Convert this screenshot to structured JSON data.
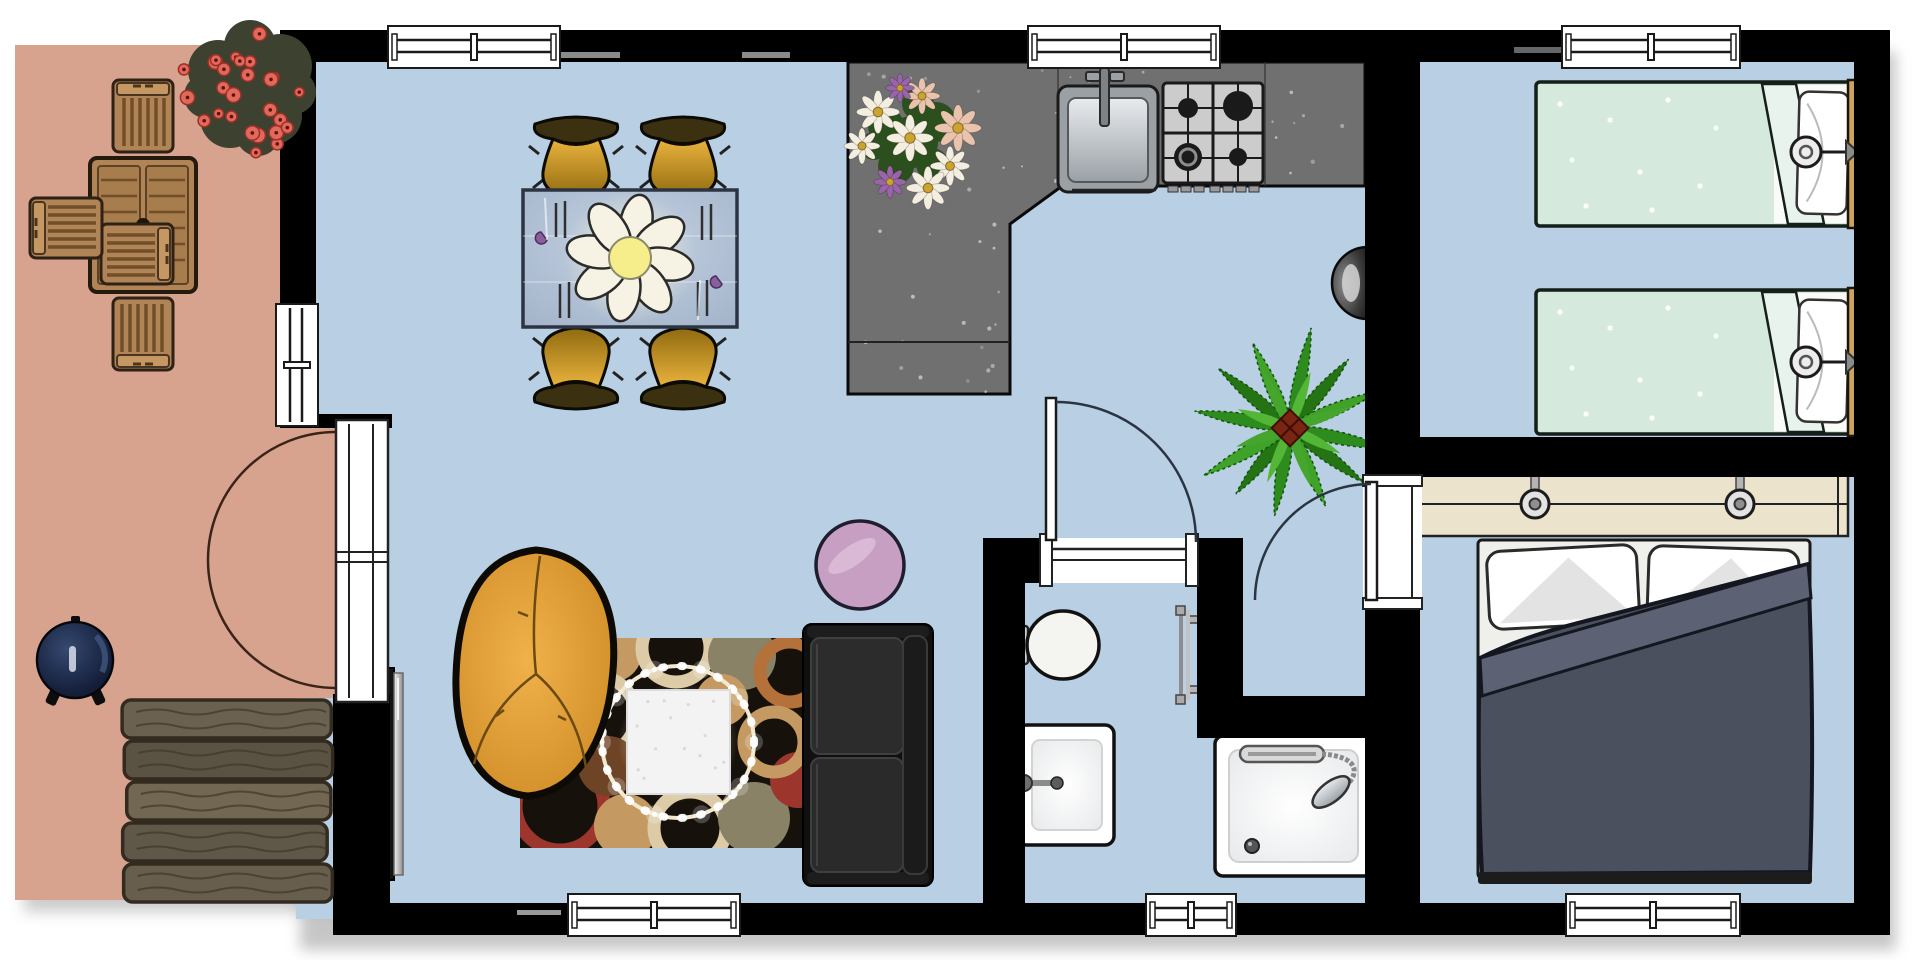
{
  "meta": {
    "type": "floor-plan",
    "view": "top-down 2D architectural drawing",
    "background": "#ffffff",
    "text_labels_visible": "none"
  },
  "palette": {
    "wall": "#000000",
    "floor": "#b9cfe4",
    "terrace_floor": "#d7a38f",
    "counter": "#707070",
    "counter_speckle": "#ffffff",
    "wood": "#b08457",
    "wood_dark": "#2e2115",
    "gold_chair": "#dba42e",
    "glass_table": "#aebdd2",
    "mint_bed": "#d5e9dd",
    "sheet_white": "#fafaf8",
    "headboard": "#c9a35f",
    "duvet": "#4b505f",
    "duvet_fold": "#5c6173",
    "dresser": "#ece3cd",
    "rug_base": "#17110b",
    "rug_red": "#9c352b",
    "rug_tan": "#c49a62",
    "rug_cream": "#dccba6",
    "rug_khaki": "#8a8266",
    "rug_orange": "#b5713a",
    "pink_rug": "#c79fc3",
    "bean_bag": "#e2a239",
    "sofa": "#161616",
    "plant_greens": [
      "#2e8c1e",
      "#247414",
      "#3fa32a"
    ],
    "plant_inner_greens": [
      "#54b637",
      "#46a52c"
    ],
    "bush_flower": "#e0695c",
    "bush_base": "#3c4130",
    "daisy_white": "#f4eee1",
    "daisy_pink": "#e9c3ab",
    "daisy_purple": "#9a64aa",
    "steel": "#c9ced2",
    "bbq": "#1c2b4e"
  },
  "rooms": [
    {
      "id": "terrace",
      "label": "Terrace patio",
      "furniture": [
        "wooden slatted dining table",
        "wooden chair top",
        "wooden chair bottom",
        "wooden chair left",
        "wooden chair right",
        "red flowering shrub",
        "round barbecue grill",
        "wooden deck steps"
      ]
    },
    {
      "id": "living-kitchen",
      "label": "Open plan living room and kitchen",
      "furniture": [
        "glass dining table",
        "4 gold dining chairs",
        "pendant flower lamp",
        "cutlery settings",
        "L-shaped speckled kitchen counter",
        "stainless sink with faucet",
        "4-burner gas hob",
        "flower bouquet on counter",
        "wall mounted half-dome fixture",
        "potted palm plant",
        "pink round rug",
        "tan leather bean bag",
        "patterned circle rug",
        "white light-ring coffee table",
        "black two-seat sofa",
        "wall mounted TV"
      ]
    },
    {
      "id": "bathroom",
      "label": "Bathroom",
      "furniture": [
        "toilet",
        "square washbasin with faucet",
        "towel radiator",
        "shower tray with hand shower"
      ]
    },
    {
      "id": "twin-bedroom",
      "label": "Twin bedroom",
      "furniture": [
        "single bed 1 mint duvet",
        "single bed 2 mint duvet",
        "wall reading lamp 1",
        "wall reading lamp 2"
      ]
    },
    {
      "id": "master-bedroom",
      "label": "Master bedroom",
      "furniture": [
        "cream sideboard shelf",
        "2 shelf lamps with wall pulls",
        "double bed with slate duvet and two pillows"
      ]
    }
  ],
  "openings": {
    "window_count": 7,
    "windows": [
      "top wall above dining table",
      "top wall above kitchen sink",
      "top wall twin bedroom",
      "bottom wall living room",
      "bottom wall bathroom corridor",
      "bottom wall master bedroom",
      "left wall terrace side"
    ],
    "doors": [
      "french double doors terrace to living room",
      "bathroom door swinging into living room",
      "master bedroom door swinging into corridor"
    ]
  }
}
